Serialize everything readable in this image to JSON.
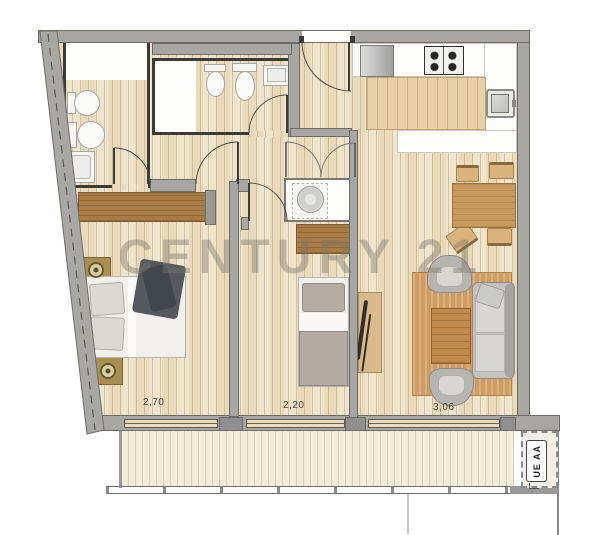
{
  "watermark": {
    "text": "CENTURY 21"
  },
  "dimensions": {
    "bedroom1": "2,70",
    "bedroom2": "2,20",
    "living": "3,06"
  },
  "ac_label": {
    "text": "UE AA"
  },
  "palette": {
    "wall_gray": "#a8a6a3",
    "wall_dark": "#3b3b37",
    "floor_wood": "#efe4cc",
    "balcony_wood": "#f3ebd9",
    "furniture_wood": "#a97c46",
    "rug": "#cf9d63",
    "upholstery_gray": "#c4c2bf",
    "watermark_gray": "#7a746c"
  },
  "fixtures": [
    "toilet",
    "bidet",
    "bathroom-sink",
    "washing-machine",
    "stove",
    "kitchen-sink",
    "refrigerator",
    "double-bed",
    "single-bed",
    "sofa",
    "armchair",
    "coffee-table",
    "rug",
    "dining-table",
    "chair",
    "wardrobe",
    "dresser",
    "tv-console",
    "nightstand",
    "ac-outdoor-unit"
  ]
}
